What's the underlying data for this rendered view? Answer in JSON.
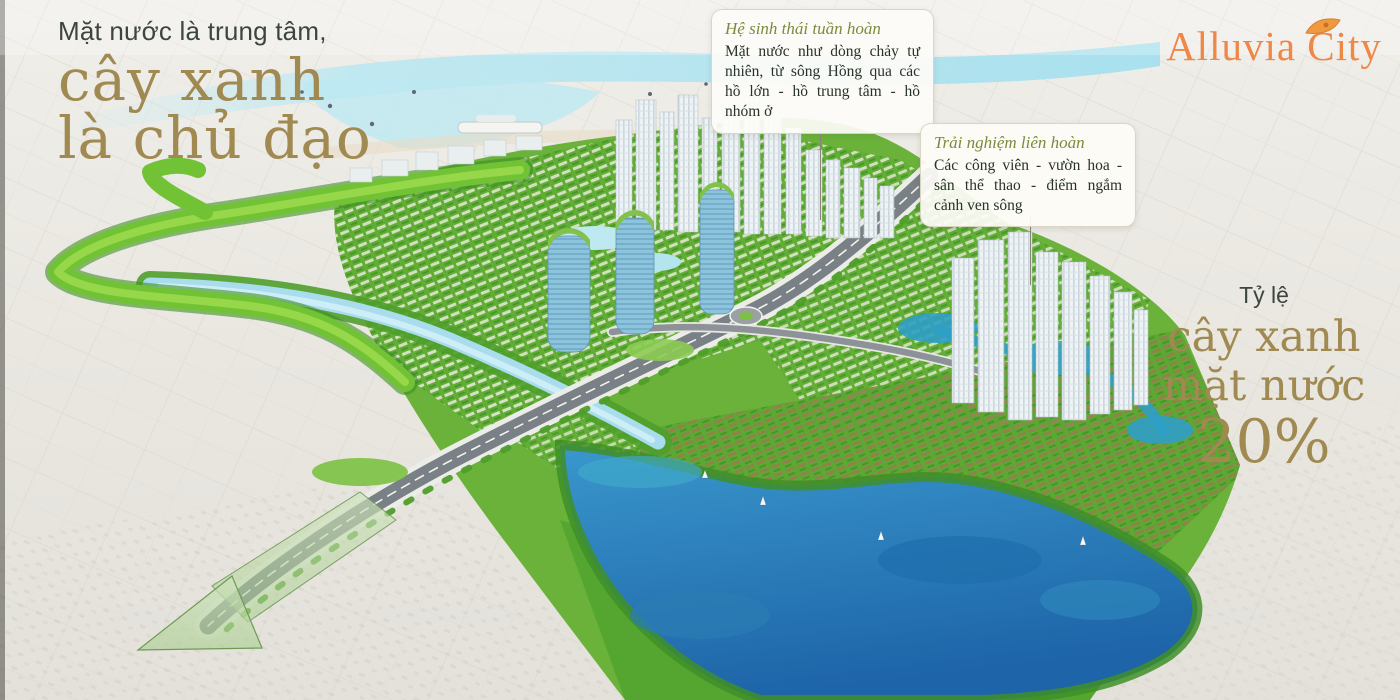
{
  "headline": {
    "intro": "Mặt nước là trung tâm,",
    "line1": "cây xanh",
    "line2": "là chủ đạo"
  },
  "callouts": [
    {
      "title": "Hệ sinh thái tuần hoàn",
      "body": "Mặt nước như dòng chảy tự nhiên, từ sông Hồng qua các hồ lớn - hồ trung tâm - hồ nhóm ở"
    },
    {
      "title": "Trải nghiệm liên hoàn",
      "body": "Các công viên - vườn hoa - sân thể thao - điểm ngắm cảnh ven sông"
    }
  ],
  "stat": {
    "label": "Tỷ lệ",
    "line1": "cây xanh",
    "line2": "mặt nước",
    "value": "20%"
  },
  "brand": {
    "name": "Alluvia City",
    "icon": "leaf-icon"
  },
  "colors": {
    "gold": "#a08a52",
    "olive": "#7a8b3d",
    "orange": "#ef8747",
    "ink": "#3d463e"
  }
}
